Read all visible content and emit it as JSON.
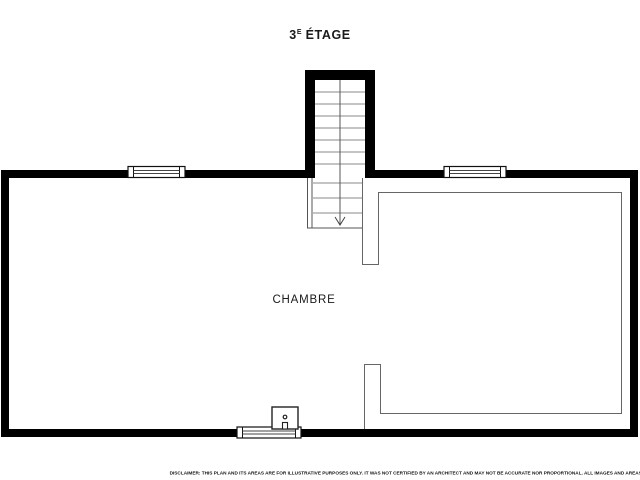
{
  "header": {
    "floor_number": "3",
    "floor_exponent": "E",
    "floor_word": "ÉTAGE"
  },
  "plan": {
    "room_label": "CHAMBRE",
    "stair_direction": "down",
    "window_count": 3
  },
  "footer": {
    "disclaimer": "DISCLAIMER: THIS PLAN AND ITS AREAS ARE FOR ILLUSTRATIVE PURPOSES ONLY. IT WAS NOT CERTIFIED BY AN ARCHITECT AND MAY NOT BE ACCURATE NOR PROPORTIONAL. ALL IMAGES AND AREAS/DIMENSIONS ARE NOT INTENDED TO FORM ANY CONTRACT OR WARRANTY."
  },
  "colors": {
    "wall": "#000000",
    "thin_line": "#666666",
    "tread_line": "#8a8a8a",
    "text": "#1a1a1a",
    "background": "#ffffff"
  }
}
